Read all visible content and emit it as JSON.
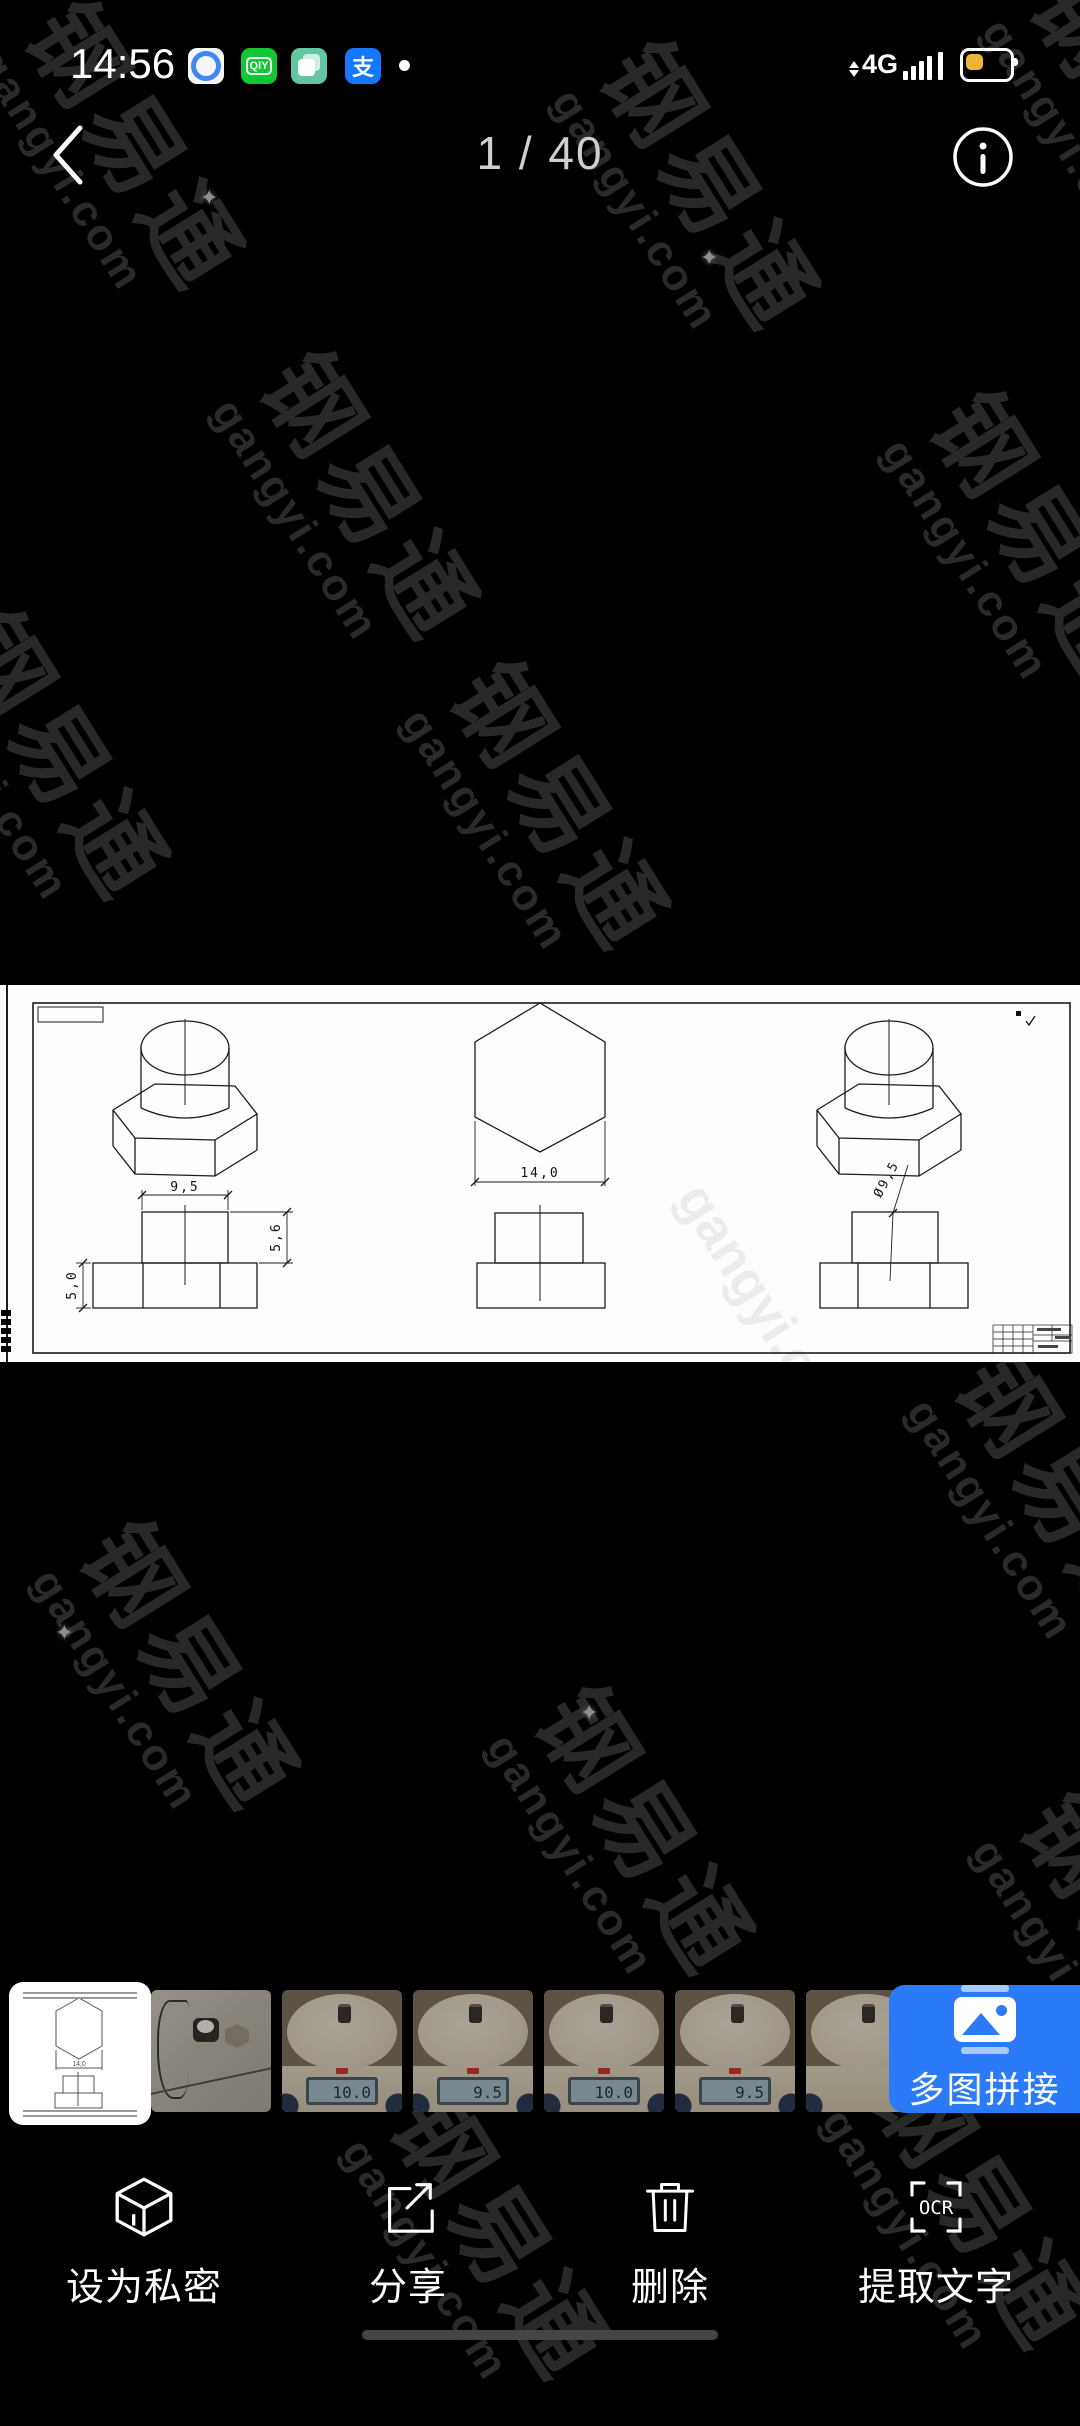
{
  "status_bar": {
    "time": "14:56",
    "network": "4G",
    "iqiyi_glyph": "QIY",
    "alipay_glyph": "支"
  },
  "header": {
    "counter": "1 / 40"
  },
  "watermark": {
    "brand": "钢易通",
    "domain": "gangyi.com"
  },
  "sheet": {
    "dims": {
      "boss_width": "9,5",
      "boss_height": "5,6",
      "nut_height": "5,0",
      "hex_width": "14,0",
      "boss_diameter": "Ø9,5"
    }
  },
  "thumbnails": {
    "selected_dim_label": "14,0",
    "items": [
      {
        "type": "drawing"
      },
      {
        "type": "photo-sketch"
      },
      {
        "type": "photo-scale",
        "lcd": "10.0"
      },
      {
        "type": "photo-scale",
        "lcd": "9.5"
      },
      {
        "type": "photo-scale",
        "lcd": "10.0"
      },
      {
        "type": "photo-scale",
        "lcd": "9.5"
      },
      {
        "type": "photo-scale",
        "lcd": ""
      }
    ]
  },
  "stitch_button": {
    "label": "多图拼接"
  },
  "toolbar": {
    "items": [
      {
        "label": "设为私密"
      },
      {
        "label": "分享"
      },
      {
        "label": "删除"
      },
      {
        "label": "提取文字",
        "icon_label": "OCR"
      }
    ]
  },
  "colors": {
    "accent_blue": "#2b7bf8",
    "battery_yellow": "#eeb535"
  }
}
